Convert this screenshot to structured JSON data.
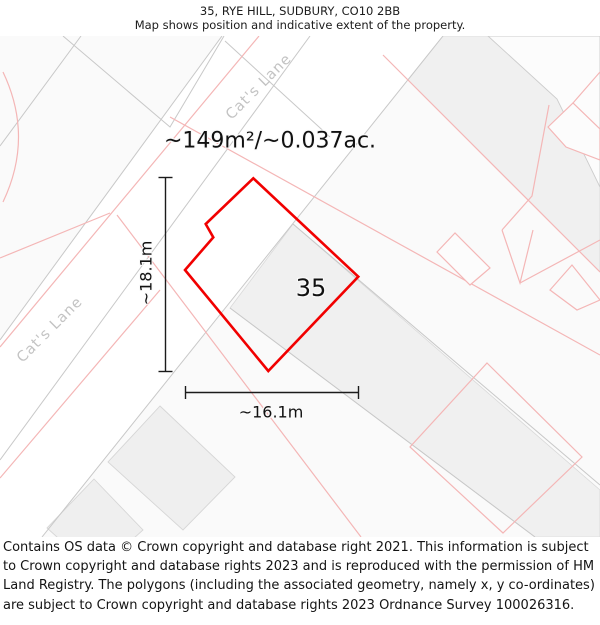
{
  "header": {
    "title": "35, RYE HILL, SUDBURY, CO10 2BB",
    "subtitle": "Map shows position and indicative extent of the property."
  },
  "map": {
    "area_label": "~149m²/~0.037ac.",
    "plot_number": "35",
    "dimensions": {
      "vertical": "~18.1m",
      "horizontal": "~16.1m"
    },
    "street_labels": [
      {
        "text": "Cat's Lane"
      },
      {
        "text": "Cat's Lane"
      }
    ],
    "colors": {
      "plot_outline": "#f10000",
      "parcel_line": "#f4b6b6",
      "boundary_line": "#c8c8c8",
      "building_fill": "#f0f0f0",
      "road_fill": "#ffffff",
      "street_label": "#c3c3c3",
      "dimension_line": "#1b1b1b"
    }
  },
  "footer": {
    "attribution": "Contains OS data © Crown copyright and database right 2021. This information is subject to Crown copyright and database rights 2023 and is reproduced with the permission of HM Land Registry. The polygons (including the associated geometry, namely x, y co-ordinates) are subject to Crown copyright and database rights 2023 Ordnance Survey 100026316."
  }
}
